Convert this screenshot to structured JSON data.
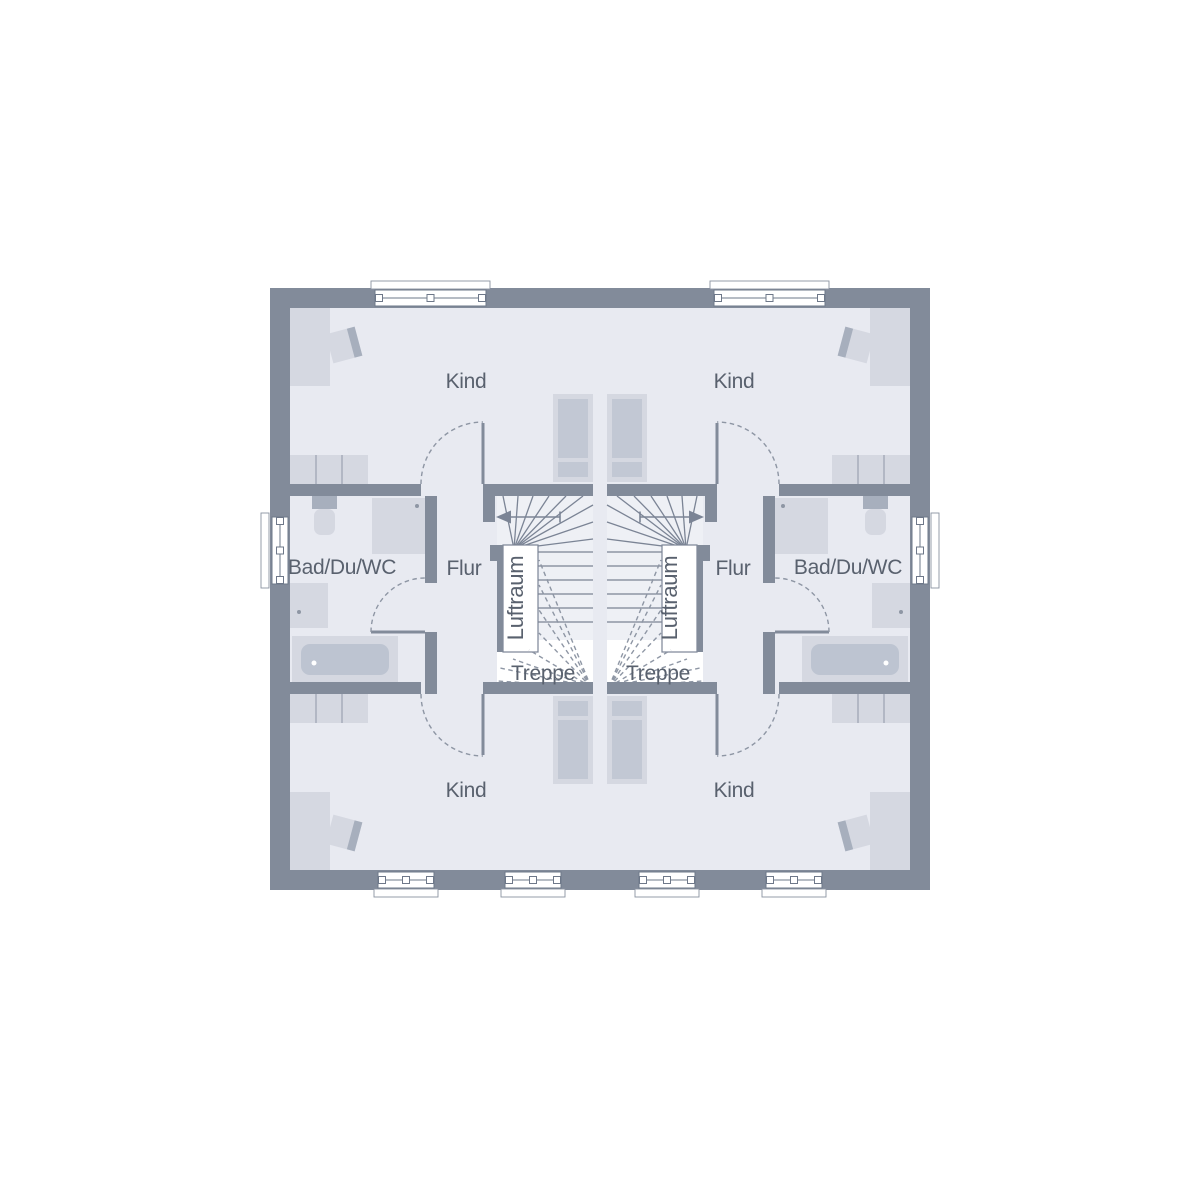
{
  "labels": {
    "kind": "Kind",
    "bath": "Bad/Du/WC",
    "hall": "Flur",
    "stairs": "Treppe",
    "air_space": "Luftraum"
  },
  "palette": {
    "wall": "#828b9a",
    "floor": "#e8eaf1",
    "stair_floor": "#eef0f5",
    "furniture_light": "#d5d8e1",
    "furniture_mid": "#c2c8d4",
    "furniture_dark": "#a7afbd",
    "line": "#7b8495",
    "dash": "#8e96a4",
    "text": "#59616e",
    "white": "#ffffff",
    "background": "#ffffff"
  }
}
